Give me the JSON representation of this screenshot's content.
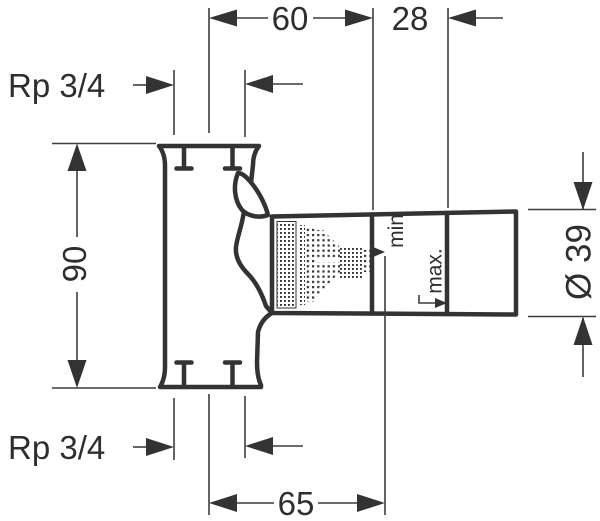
{
  "drawing": {
    "dims": {
      "top_width": "60",
      "top_offset": "28",
      "height": "90",
      "bottom_width": "65",
      "diameter": "Ø 39"
    },
    "threads": {
      "top": "Rp 3/4",
      "bottom": "Rp 3/4"
    },
    "depth_marks": {
      "min": "min",
      "max": "max."
    },
    "colors": {
      "line": "#333333",
      "thin_line": "#3d3d3d",
      "background": "#ffffff"
    }
  }
}
